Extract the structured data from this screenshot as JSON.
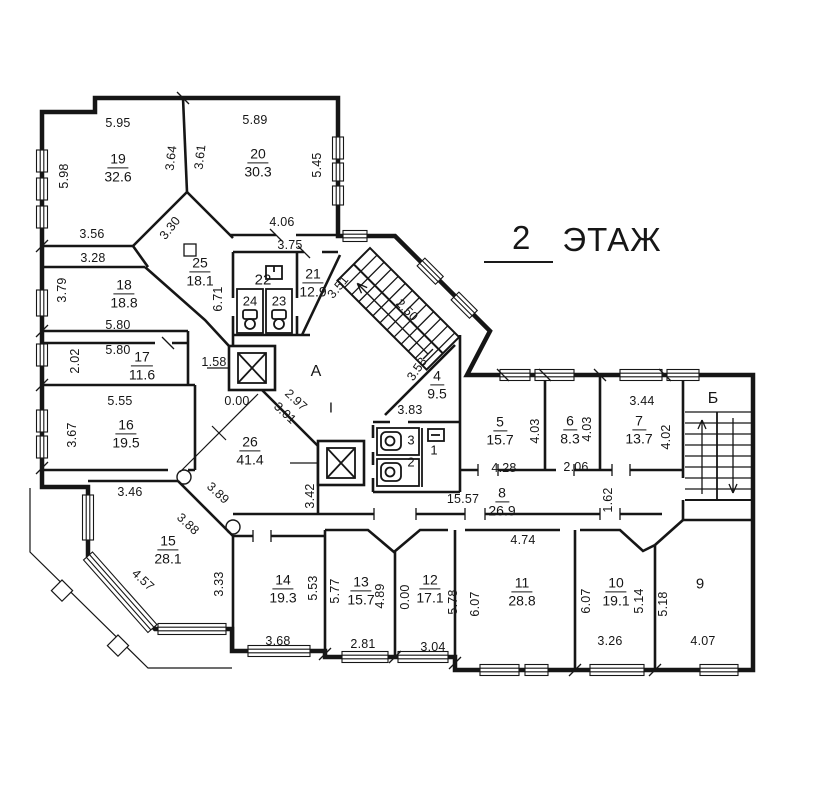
{
  "title": {
    "floor_number": "2",
    "floor_word": "ЭТАЖ"
  },
  "plan": {
    "rooms": [
      {
        "num": "19",
        "area": "32.6",
        "x": 118,
        "y": 168
      },
      {
        "num": "20",
        "area": "30.3",
        "x": 258,
        "y": 163
      },
      {
        "num": "18",
        "area": "18.8",
        "x": 124,
        "y": 294
      },
      {
        "num": "25",
        "area": "18.1",
        "x": 200,
        "y": 272
      },
      {
        "num": "21",
        "area": "12.9",
        "x": 313,
        "y": 283
      },
      {
        "num": "17",
        "area": "11.6",
        "x": 142,
        "y": 366
      },
      {
        "num": "16",
        "area": "19.5",
        "x": 126,
        "y": 434
      },
      {
        "num": "26",
        "area": "41.4",
        "x": 250,
        "y": 451
      },
      {
        "num": "4",
        "area": "9.5",
        "x": 437,
        "y": 385
      },
      {
        "num": "5",
        "area": "15.7",
        "x": 500,
        "y": 431
      },
      {
        "num": "6",
        "area": "8.3",
        "x": 570,
        "y": 430
      },
      {
        "num": "7",
        "area": "13.7",
        "x": 639,
        "y": 430
      },
      {
        "num": "8",
        "area": "26.9",
        "x": 502,
        "y": 502
      },
      {
        "num": "15",
        "area": "28.1",
        "x": 168,
        "y": 550
      },
      {
        "num": "14",
        "area": "19.3",
        "x": 283,
        "y": 589
      },
      {
        "num": "13",
        "area": "15.7",
        "x": 361,
        "y": 591
      },
      {
        "num": "12",
        "area": "17.1",
        "x": 430,
        "y": 589
      },
      {
        "num": "11",
        "area": "28.8",
        "x": 522,
        "y": 592
      },
      {
        "num": "10",
        "area": "19.1",
        "x": 616,
        "y": 592
      }
    ],
    "marks": [
      {
        "text": "22",
        "x": 263,
        "y": 280,
        "size": 15
      },
      {
        "text": "24",
        "x": 250,
        "y": 301,
        "size": 13
      },
      {
        "text": "23",
        "x": 279,
        "y": 301,
        "size": 13
      },
      {
        "text": "А",
        "x": 316,
        "y": 372,
        "size": 16
      },
      {
        "text": "I",
        "x": 331,
        "y": 408,
        "size": 15
      },
      {
        "text": "3",
        "x": 411,
        "y": 440,
        "size": 13
      },
      {
        "text": "2",
        "x": 411,
        "y": 462,
        "size": 13
      },
      {
        "text": "1",
        "x": 434,
        "y": 450,
        "size": 13
      },
      {
        "text": "Б",
        "x": 713,
        "y": 399,
        "size": 16
      },
      {
        "text": "9",
        "x": 700,
        "y": 584,
        "size": 15
      }
    ],
    "dims": [
      {
        "text": "5.95",
        "x": 118,
        "y": 123,
        "rot": 0
      },
      {
        "text": "5.89",
        "x": 255,
        "y": 120,
        "rot": 0
      },
      {
        "text": "5.98",
        "x": 64,
        "y": 176,
        "rot": -90
      },
      {
        "text": "3.64",
        "x": 171,
        "y": 158,
        "rot": -83
      },
      {
        "text": "3.61",
        "x": 200,
        "y": 157,
        "rot": -83
      },
      {
        "text": "5.45",
        "x": 317,
        "y": 165,
        "rot": -90
      },
      {
        "text": "3.30",
        "x": 170,
        "y": 228,
        "rot": -52
      },
      {
        "text": "4.06",
        "x": 282,
        "y": 222,
        "rot": 0
      },
      {
        "text": "3.56",
        "x": 92,
        "y": 234,
        "rot": 0
      },
      {
        "text": "3.75",
        "x": 290,
        "y": 245,
        "rot": 0
      },
      {
        "text": "3.28",
        "x": 93,
        "y": 258,
        "rot": 0
      },
      {
        "text": "3.79",
        "x": 62,
        "y": 290,
        "rot": -90
      },
      {
        "text": "6.71",
        "x": 218,
        "y": 299,
        "rot": -90
      },
      {
        "text": "3.51",
        "x": 338,
        "y": 287,
        "rot": -50
      },
      {
        "text": "2.50",
        "x": 407,
        "y": 310,
        "rot": 45
      },
      {
        "text": "5.80",
        "x": 118,
        "y": 325,
        "rot": 0
      },
      {
        "text": "5.80",
        "x": 118,
        "y": 350,
        "rot": 0
      },
      {
        "text": "2.02",
        "x": 75,
        "y": 361,
        "rot": -90
      },
      {
        "text": "1.58",
        "x": 214,
        "y": 362,
        "rot": 0
      },
      {
        "text": "5.55",
        "x": 120,
        "y": 401,
        "rot": 0
      },
      {
        "text": "3.67",
        "x": 72,
        "y": 435,
        "rot": -90
      },
      {
        "text": "0.00",
        "x": 237,
        "y": 401,
        "rot": 0
      },
      {
        "text": "2.97",
        "x": 296,
        "y": 400,
        "rot": 43
      },
      {
        "text": "3.01",
        "x": 285,
        "y": 413,
        "rot": 43
      },
      {
        "text": "3.58",
        "x": 417,
        "y": 369,
        "rot": -55
      },
      {
        "text": "3.83",
        "x": 410,
        "y": 410,
        "rot": 0
      },
      {
        "text": "3.46",
        "x": 130,
        "y": 492,
        "rot": 0
      },
      {
        "text": "3.89",
        "x": 218,
        "y": 493,
        "rot": 43
      },
      {
        "text": "3.88",
        "x": 188,
        "y": 524,
        "rot": 43
      },
      {
        "text": "3.42",
        "x": 310,
        "y": 496,
        "rot": -90
      },
      {
        "text": "4.57",
        "x": 143,
        "y": 580,
        "rot": 43
      },
      {
        "text": "3.33",
        "x": 219,
        "y": 584,
        "rot": -90
      },
      {
        "text": "5.53",
        "x": 313,
        "y": 588,
        "rot": -90
      },
      {
        "text": "3.68",
        "x": 278,
        "y": 641,
        "rot": 0
      },
      {
        "text": "5.77",
        "x": 335,
        "y": 591,
        "rot": -90
      },
      {
        "text": "4.89",
        "x": 380,
        "y": 596,
        "rot": -90
      },
      {
        "text": "2.81",
        "x": 363,
        "y": 644,
        "rot": 0
      },
      {
        "text": "0.00",
        "x": 405,
        "y": 597,
        "rot": -90
      },
      {
        "text": "5.78",
        "x": 453,
        "y": 602,
        "rot": -90
      },
      {
        "text": "3.04",
        "x": 433,
        "y": 647,
        "rot": 0
      },
      {
        "text": "6.07",
        "x": 475,
        "y": 604,
        "rot": -90
      },
      {
        "text": "4.74",
        "x": 523,
        "y": 540,
        "rot": 0
      },
      {
        "text": "6.07",
        "x": 586,
        "y": 601,
        "rot": -90
      },
      {
        "text": "1.62",
        "x": 608,
        "y": 500,
        "rot": -90
      },
      {
        "text": "5.14",
        "x": 639,
        "y": 601,
        "rot": -90
      },
      {
        "text": "3.26",
        "x": 610,
        "y": 641,
        "rot": 0
      },
      {
        "text": "5.18",
        "x": 663,
        "y": 604,
        "rot": -90
      },
      {
        "text": "4.07",
        "x": 703,
        "y": 641,
        "rot": 0
      },
      {
        "text": "15.57",
        "x": 463,
        "y": 499,
        "rot": 0
      },
      {
        "text": "4.28",
        "x": 504,
        "y": 468,
        "rot": 0
      },
      {
        "text": "2.06",
        "x": 576,
        "y": 467,
        "rot": 0
      },
      {
        "text": "4.03",
        "x": 535,
        "y": 431,
        "rot": -90
      },
      {
        "text": "4.03",
        "x": 587,
        "y": 429,
        "rot": -90
      },
      {
        "text": "3.44",
        "x": 642,
        "y": 401,
        "rot": 0
      },
      {
        "text": "4.02",
        "x": 666,
        "y": 437,
        "rot": -90
      }
    ]
  },
  "colors": {
    "ink": "#161616",
    "background": "#ffffff"
  }
}
